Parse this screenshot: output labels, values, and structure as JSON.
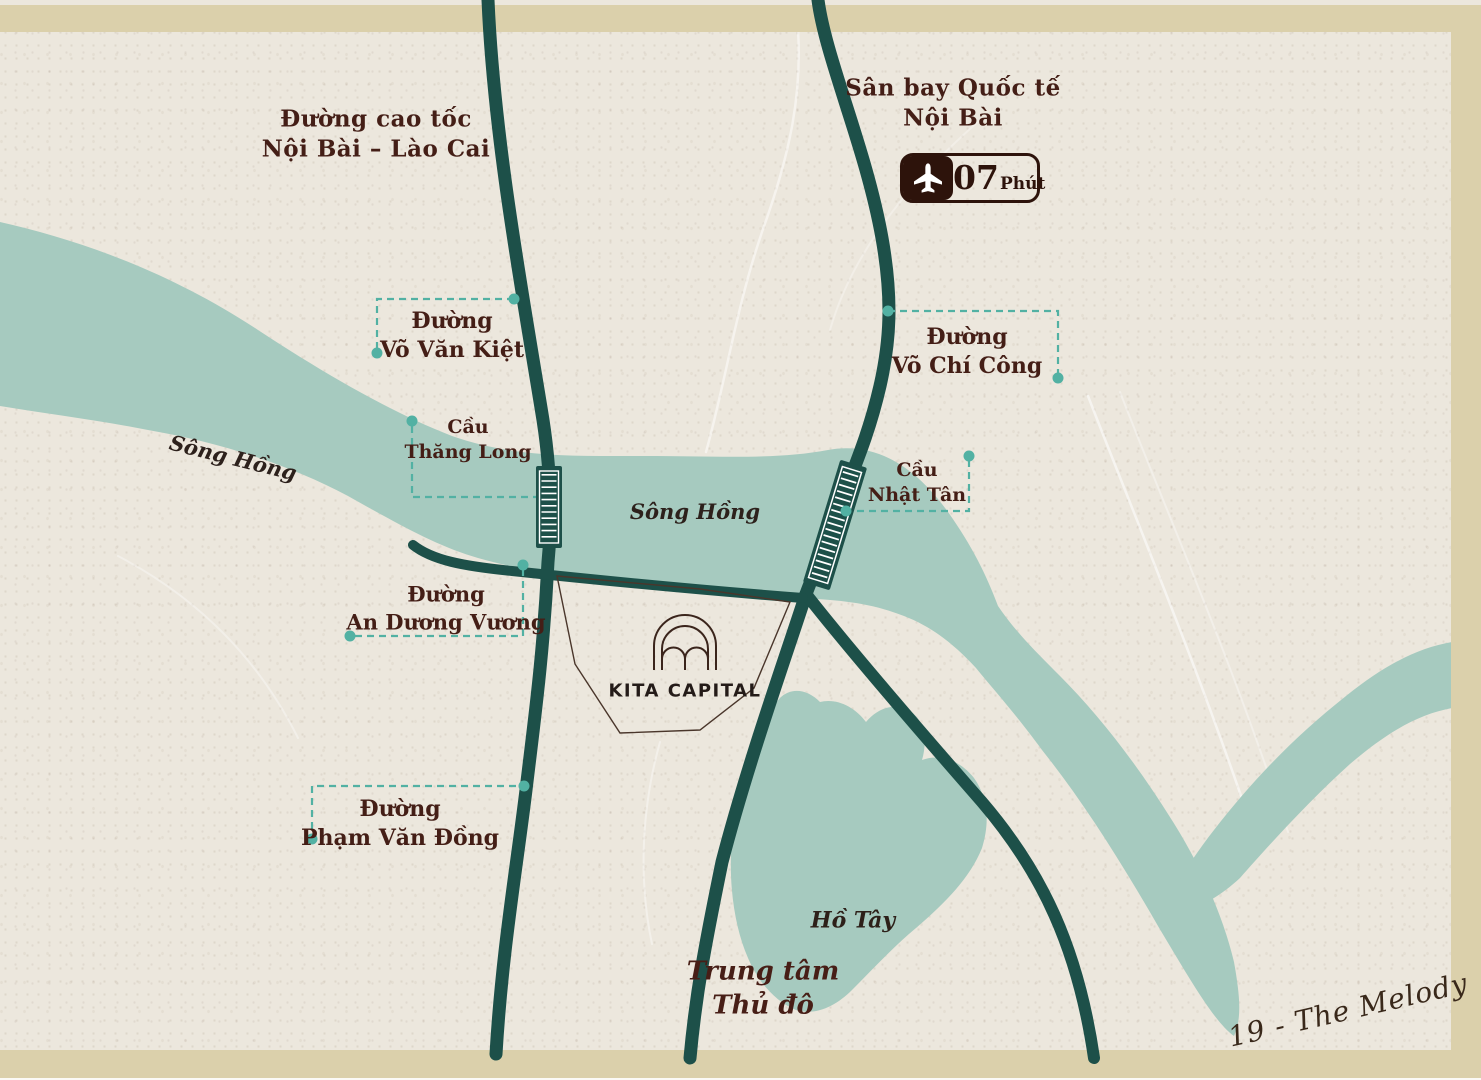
{
  "map": {
    "expressway_label": {
      "line1": "Đường cao tốc",
      "line2": "Nội Bài – Lào Cai"
    },
    "airport": {
      "name_line1": "Sân bay Quốc tế",
      "name_line2": "Nội Bài",
      "travel_time_value": "07",
      "travel_time_unit": "Phút"
    },
    "roads": {
      "vo_van_kiet": {
        "line1": "Đường",
        "line2": "Võ Văn Kiệt"
      },
      "vo_chi_cong": {
        "line1": "Đường",
        "line2": "Võ Chí Công"
      },
      "an_duong_vuong": {
        "line1": "Đường",
        "line2": "An Dương Vương"
      },
      "pham_van_dong": {
        "line1": "Đường",
        "line2": "Phạm Văn Đồng"
      }
    },
    "bridges": {
      "thang_long": {
        "line1": "Cầu",
        "line2": "Thăng Long"
      },
      "nhat_tan": {
        "line1": "Cầu",
        "line2": "Nhật Tân"
      }
    },
    "water": {
      "song_hong_west": "Sông Hồng",
      "song_hong_center": "Sông Hồng",
      "ho_tay": "Hồ Tây"
    },
    "landmarks": {
      "kita_capital": "KITA CAPITAL",
      "city_center_line1": "Trung tâm",
      "city_center_line2": "Thủ đô"
    },
    "signature": "19 - The Melody",
    "colors": {
      "background": "#ece7dd",
      "frame": "#dbd0ab",
      "river": "#a6cabf",
      "road": "#1d5049",
      "label_text": "#441e16",
      "accent_teal": "#52b1a3",
      "badge_brown": "#2d130b"
    }
  }
}
